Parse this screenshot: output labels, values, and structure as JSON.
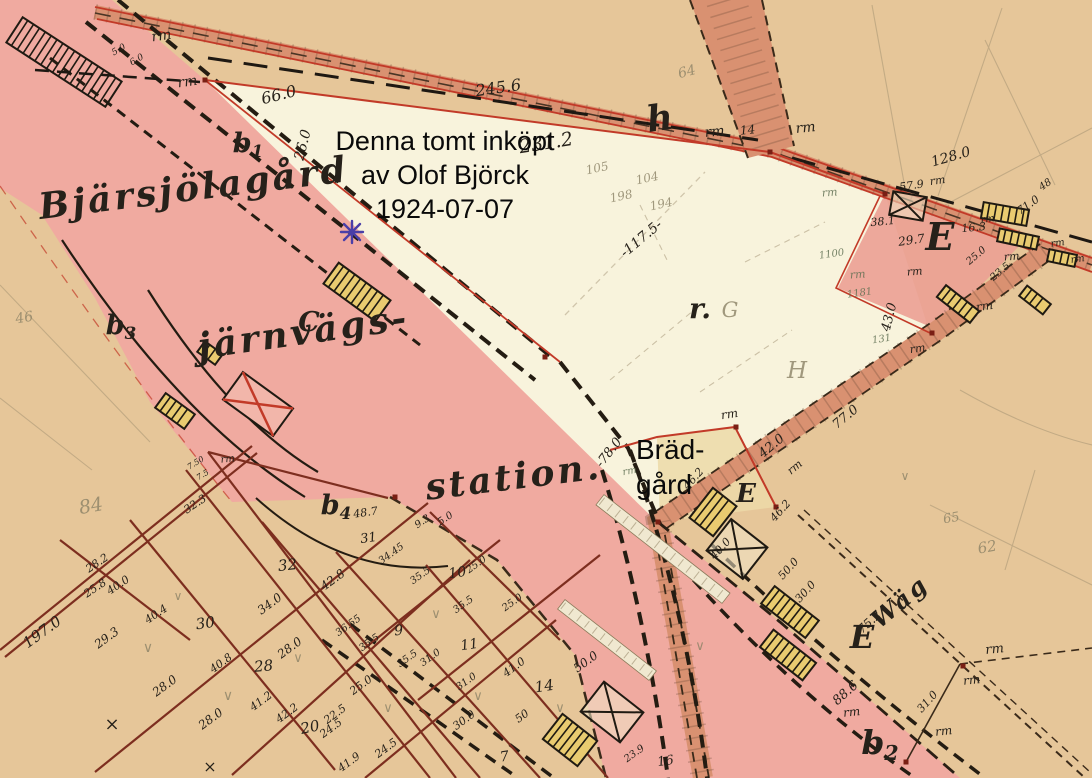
{
  "annotations": {
    "purchase_note": {
      "line1": "Denna tomt inköpt",
      "line2": "av Olof Björck",
      "line3": "1924-07-07"
    },
    "bradgard_note": {
      "line1": "Bräd-",
      "line2": "gård"
    }
  },
  "map_labels": {
    "cursive": [
      [
        "Bjärsjölagård",
        195,
        200,
        -7,
        36
      ],
      [
        "järnvägs-",
        305,
        344,
        -8,
        36
      ],
      [
        "station.",
        515,
        489,
        -7,
        36
      ],
      [
        "h",
        663,
        130,
        -8,
        36
      ],
      [
        "Wäg",
        905,
        608,
        -40,
        24
      ]
    ],
    "bold": [
      [
        "E",
        940,
        250,
        0,
        38
      ],
      [
        "E",
        746,
        502,
        0,
        26
      ],
      [
        "E",
        862,
        648,
        0,
        32
      ],
      [
        "r.",
        700,
        318,
        0,
        28
      ],
      [
        "C",
        309,
        331,
        0,
        27
      ],
      [
        "b₁",
        248,
        152,
        0,
        27
      ],
      [
        "b₃",
        121,
        334,
        0,
        27
      ],
      [
        "b₄",
        336,
        514,
        0,
        27
      ],
      [
        "b₂",
        880,
        754,
        0,
        33
      ]
    ],
    "ink": [
      [
        "rm",
        162,
        40,
        -8,
        14
      ],
      [
        "5.0",
        120,
        52,
        -30,
        9
      ],
      [
        "6.0",
        138,
        62,
        -30,
        9
      ],
      [
        "rm",
        188,
        86,
        -8,
        14
      ],
      [
        "66.0",
        280,
        100,
        -14,
        16
      ],
      [
        "26.0",
        307,
        146,
        -76,
        14
      ],
      [
        "245.6",
        499,
        93,
        -8,
        16
      ],
      [
        "231.2",
        547,
        149,
        -9,
        19
      ],
      [
        "rm",
        715,
        136,
        -6,
        14
      ],
      [
        "14",
        748,
        134,
        -6,
        12
      ],
      [
        "rm",
        806,
        132,
        -6,
        14
      ],
      [
        "128.0",
        952,
        161,
        -16,
        14
      ],
      [
        "-117.5-",
        644,
        242,
        -40,
        14
      ],
      [
        "57.9",
        912,
        189,
        -8,
        11
      ],
      [
        "rm",
        938,
        184,
        -8,
        11
      ],
      [
        "71.0",
        1030,
        208,
        -35,
        11
      ],
      [
        "48",
        1047,
        187,
        -35,
        10
      ],
      [
        "38.1",
        883,
        225,
        -5,
        11
      ],
      [
        "29.7",
        912,
        244,
        -8,
        12
      ],
      [
        "16.3",
        974,
        231,
        -5,
        11
      ],
      [
        "rm",
        915,
        275,
        -5,
        11
      ],
      [
        "rm",
        1012,
        260,
        -5,
        11
      ],
      [
        "rm",
        988,
        222,
        -8,
        10
      ],
      [
        "rm",
        1058,
        246,
        -8,
        10
      ],
      [
        "rm",
        1078,
        262,
        -8,
        10
      ],
      [
        "25.0",
        978,
        258,
        -40,
        10
      ],
      [
        "23.5",
        1002,
        274,
        -40,
        10
      ],
      [
        "43.0",
        893,
        318,
        -76,
        13
      ],
      [
        "rm",
        918,
        352,
        -8,
        11
      ],
      [
        "rm",
        985,
        310,
        -8,
        12
      ],
      [
        "77.0",
        848,
        420,
        -40,
        13
      ],
      [
        "rm",
        730,
        418,
        -8,
        12
      ],
      [
        "42.0",
        774,
        449,
        -40,
        13
      ],
      [
        "rm",
        797,
        470,
        -40,
        11
      ],
      [
        "-78.0",
        612,
        455,
        -52,
        13
      ],
      [
        "46.2",
        696,
        481,
        -48,
        11
      ],
      [
        "46.2",
        783,
        513,
        -48,
        11
      ],
      [
        "40.0",
        723,
        551,
        -48,
        11
      ],
      [
        "50.0",
        791,
        571,
        -48,
        11
      ],
      [
        "30.0",
        808,
        594,
        -48,
        11
      ],
      [
        "rm",
        228,
        462,
        -6,
        10
      ],
      [
        "7.50",
        197,
        465,
        -32,
        8
      ],
      [
        "7.5",
        204,
        477,
        -32,
        8
      ],
      [
        "32.3",
        197,
        507,
        -34,
        11
      ],
      [
        "197.0",
        45,
        636,
        -36,
        15
      ],
      [
        "28.2",
        99,
        566,
        -34,
        11
      ],
      [
        "25.8",
        97,
        591,
        -34,
        11
      ],
      [
        "40.0",
        120,
        588,
        -34,
        11
      ],
      [
        "40.4",
        158,
        617,
        -34,
        11
      ],
      [
        "29.3",
        109,
        641,
        -36,
        12
      ],
      [
        "28.0",
        167,
        689,
        -36,
        12
      ],
      [
        "30",
        206,
        628,
        -8,
        15
      ],
      [
        "40.8",
        223,
        666,
        -36,
        11
      ],
      [
        "28",
        264,
        671,
        -5,
        15
      ],
      [
        "28.0",
        213,
        722,
        -36,
        12
      ],
      [
        "41.2",
        263,
        704,
        -36,
        11
      ],
      [
        "42.2",
        289,
        716,
        -36,
        11
      ],
      [
        "20",
        311,
        732,
        -12,
        15
      ],
      [
        "22.5",
        337,
        717,
        -36,
        11
      ],
      [
        "24.5",
        388,
        751,
        -36,
        11
      ],
      [
        "41.9",
        351,
        765,
        -36,
        11
      ],
      [
        "28.0",
        292,
        651,
        -36,
        12
      ],
      [
        "34.0",
        272,
        607,
        -36,
        12
      ],
      [
        "32",
        288,
        570,
        -6,
        15
      ],
      [
        "42.8",
        335,
        583,
        -36,
        12
      ],
      [
        "36.55",
        350,
        628,
        -36,
        10
      ],
      [
        "35.5",
        371,
        645,
        -36,
        10
      ],
      [
        "9",
        399,
        635,
        -5,
        14
      ],
      [
        "35.5",
        409,
        661,
        -36,
        10
      ],
      [
        "25.0",
        363,
        688,
        -36,
        11
      ],
      [
        "24.5",
        333,
        731,
        -36,
        11
      ],
      [
        "48.7",
        366,
        516,
        -8,
        11
      ],
      [
        "31",
        369,
        542,
        -8,
        13
      ],
      [
        "34.45",
        393,
        556,
        -36,
        10
      ],
      [
        "9.3",
        424,
        524,
        -34,
        10
      ],
      [
        "5.0",
        447,
        521,
        -34,
        10
      ],
      [
        "35.5",
        422,
        578,
        -36,
        10
      ],
      [
        "10",
        458,
        577,
        -8,
        14
      ],
      [
        "25.0",
        478,
        567,
        -36,
        10
      ],
      [
        "25.0",
        514,
        605,
        -36,
        10
      ],
      [
        "35.5",
        465,
        607,
        -36,
        10
      ],
      [
        "31.0",
        432,
        660,
        -36,
        10
      ],
      [
        "11",
        470,
        649,
        -8,
        14
      ],
      [
        "31.0",
        468,
        684,
        -36,
        10
      ],
      [
        "41.0",
        516,
        670,
        -36,
        11
      ],
      [
        "14",
        545,
        691,
        -8,
        15
      ],
      [
        "50.0",
        588,
        665,
        -36,
        12
      ],
      [
        "30.0",
        466,
        723,
        -36,
        11
      ],
      [
        "50",
        524,
        719,
        -36,
        11
      ],
      [
        "7",
        505,
        761,
        -8,
        14
      ],
      [
        "23.9",
        636,
        756,
        -36,
        10
      ],
      [
        "16",
        666,
        765,
        -8,
        13
      ],
      [
        "88.6",
        848,
        696,
        -42,
        13
      ],
      [
        "31.0",
        930,
        704,
        -48,
        11
      ],
      [
        "75.2",
        872,
        625,
        -42,
        12
      ],
      [
        "rm",
        995,
        653,
        -6,
        13
      ],
      [
        "rm",
        972,
        684,
        -6,
        12
      ],
      [
        "rm",
        944,
        735,
        -6,
        12
      ],
      [
        "rm",
        852,
        716,
        -6,
        12
      ],
      [
        "×",
        112,
        730,
        0,
        18
      ],
      [
        "×",
        210,
        772,
        0,
        16
      ]
    ],
    "pencil": [
      [
        "64",
        688,
        76,
        -15,
        14
      ],
      [
        "84",
        92,
        512,
        -10,
        19
      ],
      [
        "105",
        598,
        172,
        -12,
        12
      ],
      [
        "104",
        648,
        182,
        -12,
        12
      ],
      [
        "198",
        622,
        200,
        -12,
        12
      ],
      [
        "194",
        662,
        208,
        -12,
        12
      ],
      [
        "G",
        730,
        317,
        0,
        21
      ],
      [
        "H",
        797,
        378,
        0,
        23
      ],
      [
        "62",
        988,
        552,
        -10,
        15
      ],
      [
        "65",
        952,
        522,
        -10,
        13
      ],
      [
        "46",
        25,
        322,
        -10,
        14
      ],
      [
        "∨",
        148,
        652,
        0,
        14
      ],
      [
        "∨",
        228,
        700,
        0,
        14
      ],
      [
        "∨",
        298,
        662,
        0,
        13
      ],
      [
        "∨",
        436,
        618,
        0,
        13
      ],
      [
        "∨",
        478,
        700,
        0,
        13
      ],
      [
        "∨",
        560,
        712,
        0,
        13
      ],
      [
        "∨",
        388,
        712,
        0,
        13
      ],
      [
        "∨",
        178,
        600,
        0,
        12
      ],
      [
        "∨",
        700,
        650,
        0,
        13
      ],
      [
        "∨",
        905,
        480,
        0,
        12
      ]
    ],
    "green": [
      [
        "rm",
        830,
        196,
        -5,
        11
      ],
      [
        "rm",
        858,
        278,
        -5,
        11
      ],
      [
        "rm",
        630,
        474,
        -10,
        10
      ],
      [
        "1100",
        832,
        257,
        -8,
        10
      ],
      [
        "1181",
        860,
        296,
        -8,
        10
      ],
      [
        "131",
        882,
        342,
        -8,
        10
      ]
    ]
  },
  "buildings": [
    [
      64,
      62,
      118,
      30,
      33,
      "striped-open"
    ],
    [
      357,
      292,
      64,
      26,
      36,
      "striped"
    ],
    [
      175,
      411,
      36,
      18,
      36,
      "striped"
    ],
    [
      258,
      404,
      62,
      34,
      36,
      "crossed-red"
    ],
    [
      210,
      353,
      22,
      13,
      36,
      "striped"
    ],
    [
      713,
      512,
      30,
      38,
      38,
      "striped"
    ],
    [
      737,
      549,
      46,
      40,
      38,
      "crossed-black"
    ],
    [
      790,
      612,
      56,
      22,
      38,
      "striped"
    ],
    [
      788,
      655,
      54,
      22,
      38,
      "striped"
    ],
    [
      570,
      740,
      44,
      32,
      38,
      "striped"
    ],
    [
      612,
      712,
      50,
      38,
      38,
      "crossed-black"
    ],
    [
      908,
      206,
      34,
      24,
      10,
      "crossed-black"
    ],
    [
      1005,
      214,
      46,
      16,
      10,
      "striped"
    ],
    [
      1018,
      239,
      40,
      13,
      12,
      "striped"
    ],
    [
      958,
      304,
      42,
      15,
      38,
      "striped"
    ],
    [
      1035,
      300,
      30,
      13,
      38,
      "striped"
    ],
    [
      1062,
      258,
      28,
      12,
      12,
      "striped"
    ]
  ],
  "markers": [
    [
      770,
      152
    ],
    [
      885,
      194
    ],
    [
      658,
      522
    ],
    [
      736,
      427
    ],
    [
      963,
      666
    ],
    [
      906,
      762
    ],
    [
      932,
      333
    ],
    [
      545,
      357
    ],
    [
      205,
      80
    ],
    [
      395,
      497
    ],
    [
      776,
      507
    ]
  ],
  "colors": {
    "paper": "#e6c699",
    "station_area": "#f0aaa0",
    "plot_white": "#f8f3dc",
    "road": "#d99171",
    "red_line": "#c23a28",
    "ink": "#26211a",
    "pencil": "#8b8266",
    "green_pencil": "#5f6f52",
    "building_yellow": "#e9cb70",
    "annotation": "#0a0a0a",
    "star": "#4a3fa8",
    "marker_red": "#7a1f14"
  }
}
